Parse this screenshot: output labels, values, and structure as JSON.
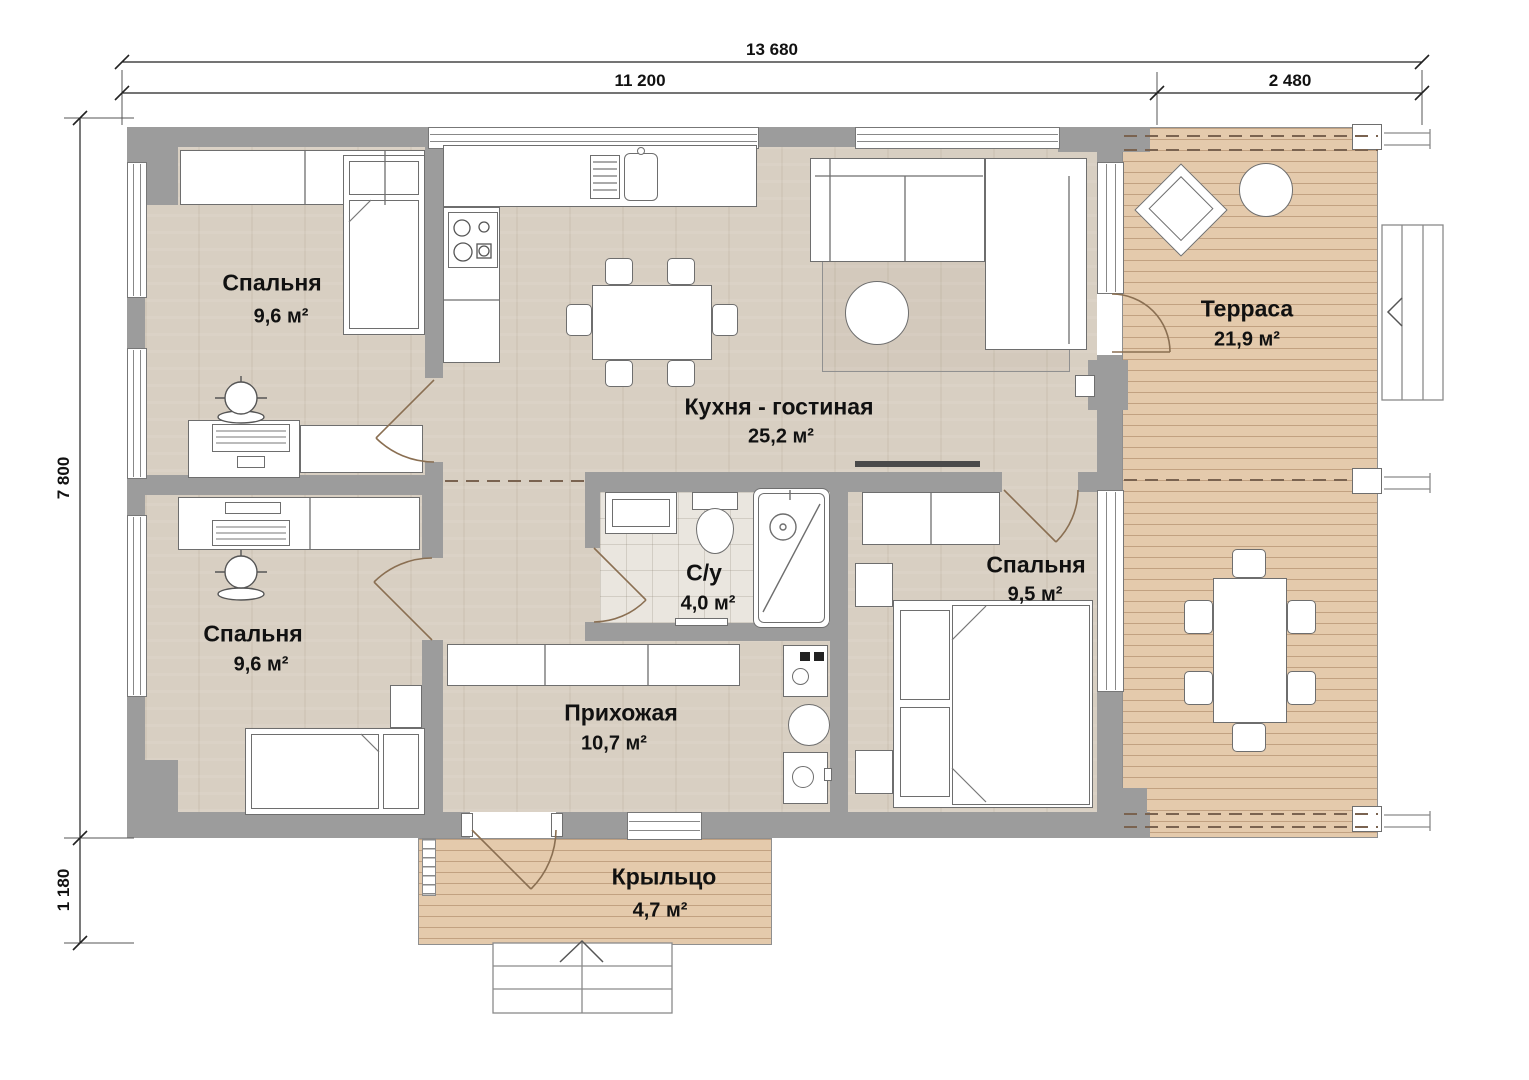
{
  "drawing": {
    "type": "floor-plan",
    "units": "mm"
  },
  "dimensions": {
    "top_total": "13 680",
    "top_house": "11 200",
    "top_terrace": "2 480",
    "left_house": "7 800",
    "left_porch": "1 180"
  },
  "rooms": [
    {
      "id": "bedroom-top-left",
      "name": "Спальня",
      "area": "9,6 м²"
    },
    {
      "id": "kitchen-living",
      "name": "Кухня - гостиная",
      "area": "25,2 м²"
    },
    {
      "id": "terrace",
      "name": "Терраса",
      "area": "21,9 м²"
    },
    {
      "id": "bedroom-bottom-left",
      "name": "Спальня",
      "area": "9,6 м²"
    },
    {
      "id": "bathroom",
      "name": "С/у",
      "area": "4,0 м²"
    },
    {
      "id": "hallway",
      "name": "Прихожая",
      "area": "10,7 м²"
    },
    {
      "id": "bedroom-right",
      "name": "Спальня",
      "area": "9,5 м²"
    },
    {
      "id": "porch",
      "name": "Крыльцо",
      "area": "4,7 м²"
    }
  ],
  "colors": {
    "wall": "#9c9c9c",
    "floor_wood": "#d8cfc2",
    "deck": "#e4caac",
    "tile": "#eae6df",
    "text": "#111111",
    "door_arc": "#8a6f52"
  }
}
